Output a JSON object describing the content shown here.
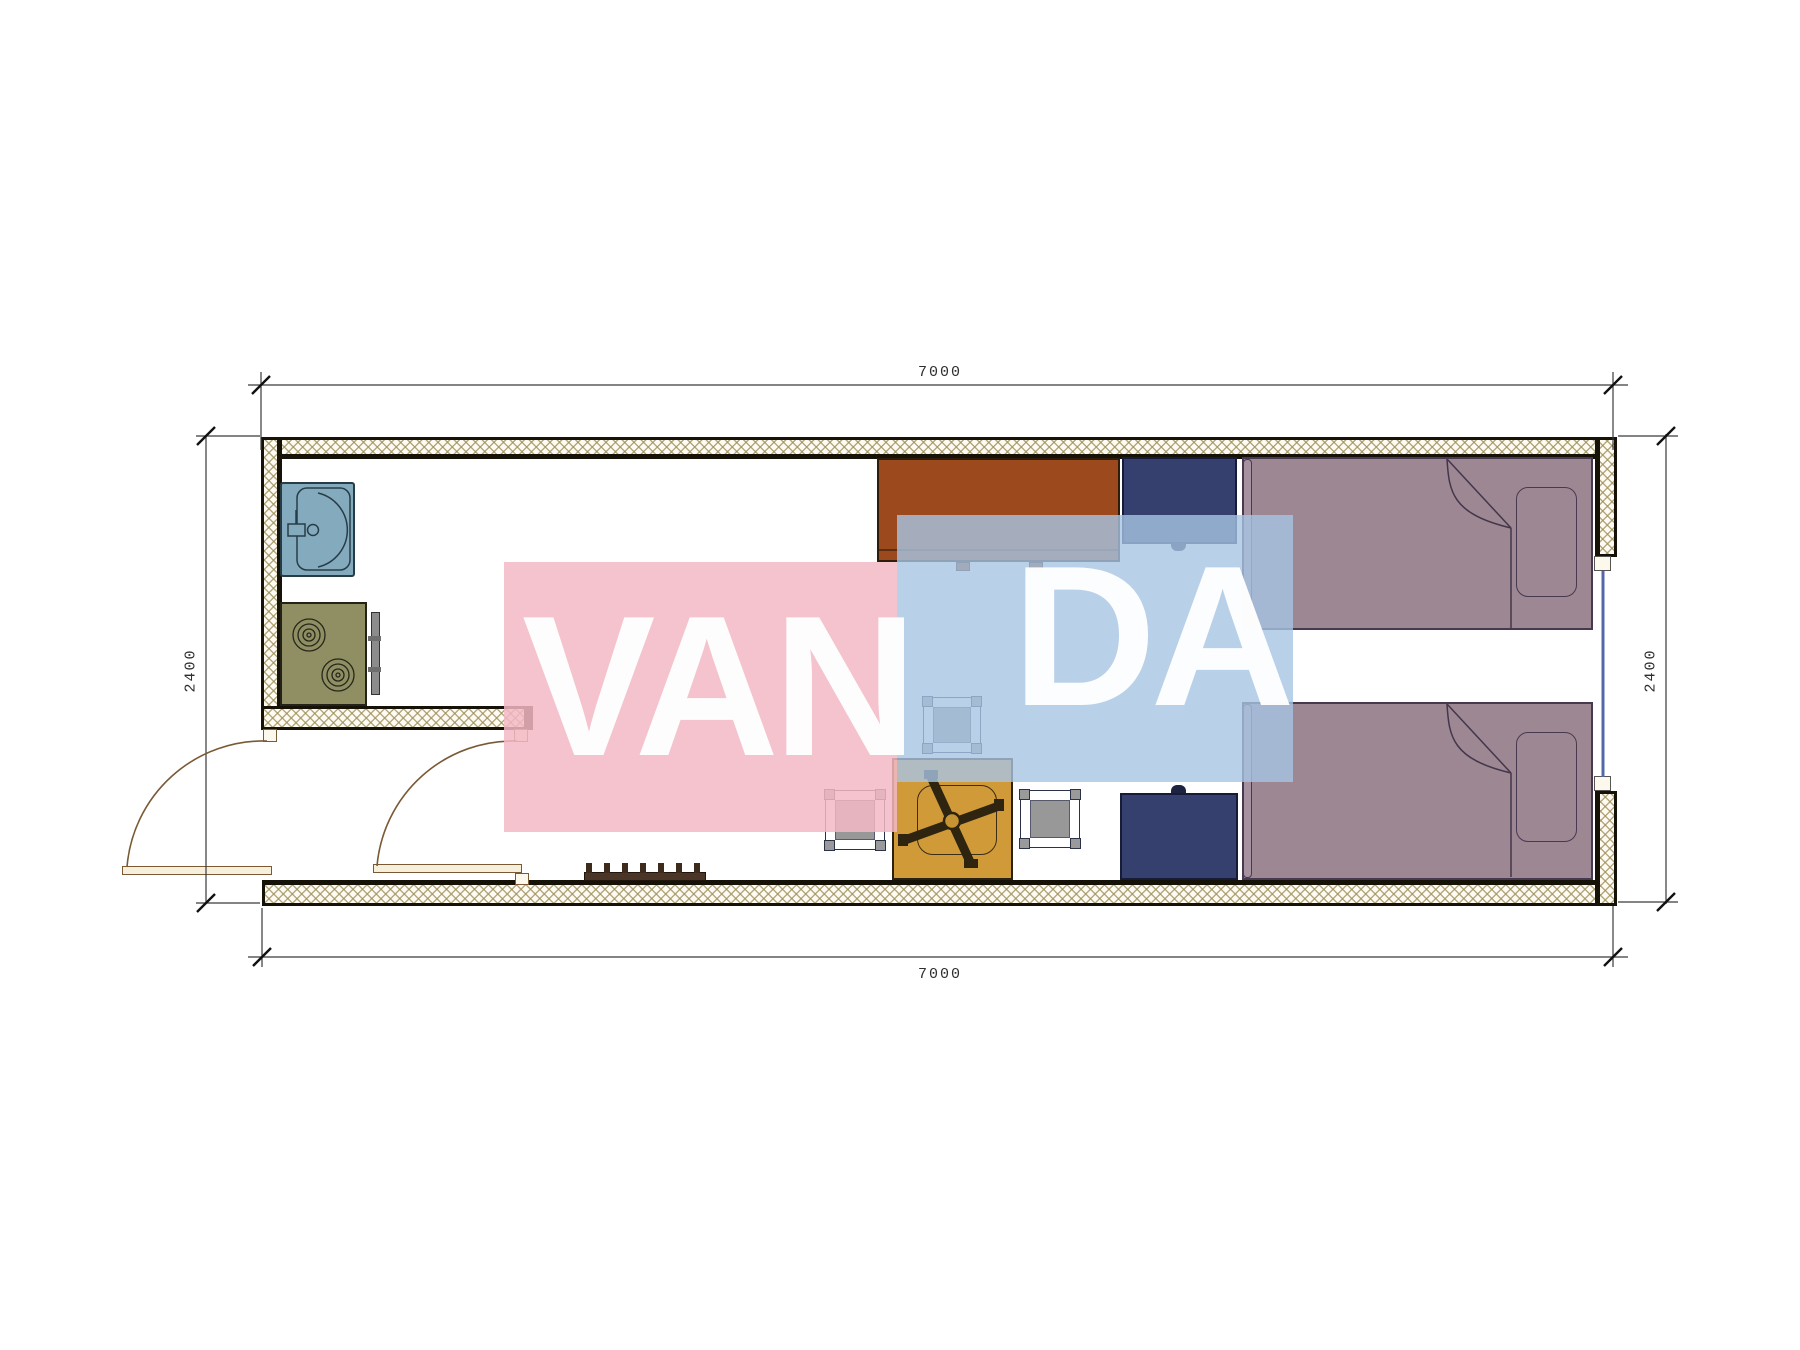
{
  "plan": {
    "dim_top": "7000",
    "dim_bottom": "7000",
    "dim_left": "2400",
    "dim_right": "2400"
  },
  "watermark": {
    "text_left": "VAN",
    "text_right": "DA",
    "pink_color": "#f3b8c4",
    "blue_color": "#a7c4e4"
  },
  "colors": {
    "wall_line": "#171208",
    "wall_hatch": "#9e8e58",
    "sink": "#84abbd",
    "stove": "#8f8f63",
    "desk": "#9c4a1d",
    "wardrobe": "#35406f",
    "bed": "#9d8793",
    "chair": "#d09a39",
    "stool": "#989898",
    "door": "#7a5a35",
    "window_glass": "#5468a8",
    "dimension_line": "#3a3a3a"
  }
}
